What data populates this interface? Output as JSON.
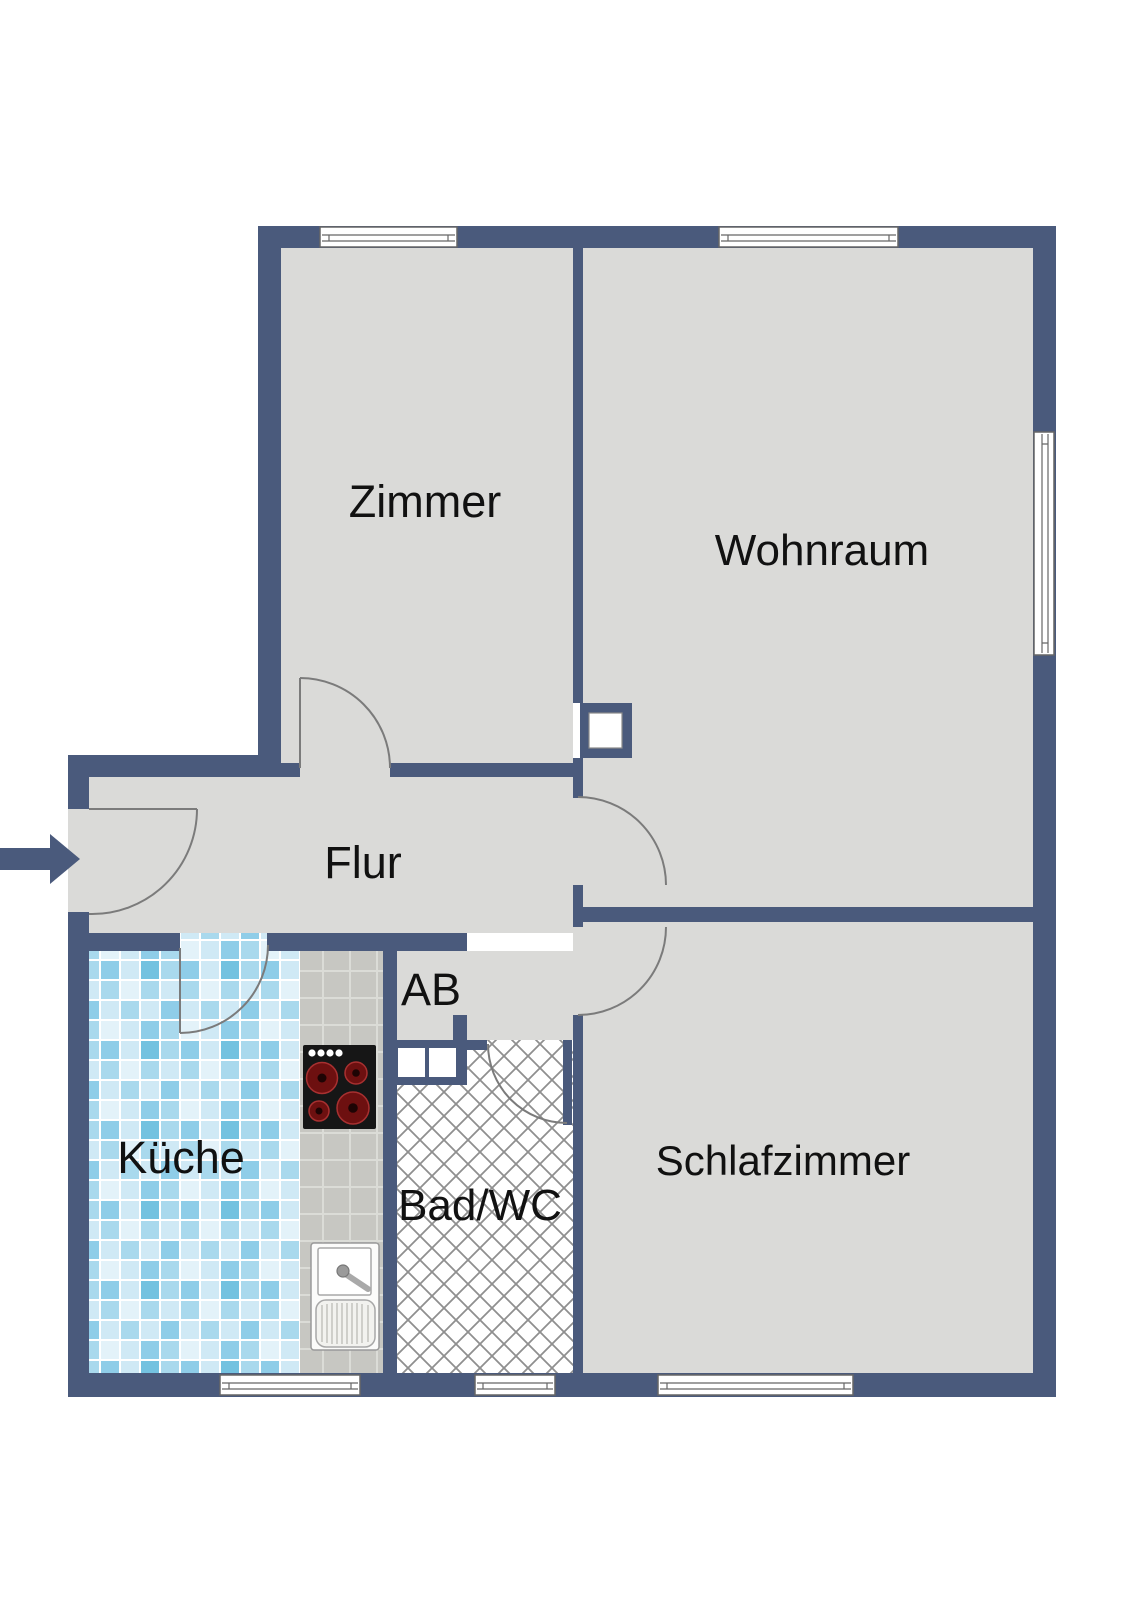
{
  "plan": {
    "kind_label": "Grundriss",
    "rooms": {
      "zimmer": {
        "label": "Zimmer"
      },
      "wohnraum": {
        "label": "Wohnraum"
      },
      "flur": {
        "label": "Flur"
      },
      "abstellraum": {
        "label": "AB"
      },
      "kueche": {
        "label": "Küche"
      },
      "bad_wc": {
        "label": "Bad/WC"
      },
      "schlafzimmer": {
        "label": "Schlafzimmer"
      }
    }
  },
  "icons": {
    "entrance_arrow": "solid right-pointing entry arrow",
    "stove": "cooktop with four burners and four knobs",
    "sink": "kitchen sink with faucet and drainboard",
    "chimney_shaft": "wall shaft / chimney box",
    "shaft_boxes": "two small wall shaft openings",
    "door_arc": "door swing arc",
    "window": "window symbol in wall"
  },
  "colors": {
    "background": "#FFFFFF",
    "wall": "#4A5A7C",
    "floor": "#DADAD8",
    "door_line": "#7B7B7B",
    "window_frame": "#666666",
    "label_text": "#111111",
    "hatch_line": "#8F8F8F",
    "hatch_bg": "#FFFFFF",
    "counter": "#C7C7C2",
    "counter_line": "#DBDCD7",
    "tile1": "#CFE9F5",
    "tile2": "#A9D9ED",
    "tile3": "#74C2E0",
    "tile4": "#8FCDE8",
    "tile5": "#E3F2F9",
    "stove_body": "#161616",
    "stove_burner": "#6D1010",
    "stove_burner_ring": "#A83030",
    "fixture_white": "#FFFFFF"
  }
}
